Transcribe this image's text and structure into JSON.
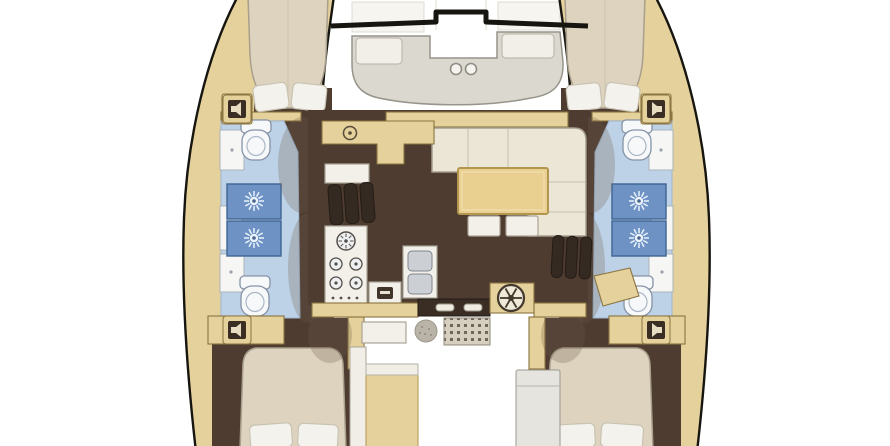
{
  "diagram": {
    "kind": "floorplan",
    "subject": "catamaran-yacht-interior-layout",
    "orientation": "bow-at-top",
    "visible_text": [],
    "features": [
      {
        "name": "forward-cockpit-bench",
        "count": 1
      },
      {
        "name": "cup-holder",
        "count": 2
      },
      {
        "name": "trampoline-crossbeam",
        "count": 1
      },
      {
        "name": "forward-cabin-berth",
        "count": 2
      },
      {
        "name": "aft-cabin-berth",
        "count": 2
      },
      {
        "name": "berth-pillow",
        "count": 8
      },
      {
        "name": "head-toilet",
        "count": 4
      },
      {
        "name": "shower-stall-with-drain",
        "count": 4
      },
      {
        "name": "vanity-cabinet",
        "count": 6
      },
      {
        "name": "deck-speaker",
        "count": 4
      },
      {
        "name": "companionway-steps",
        "count": 2
      },
      {
        "name": "galley-oven",
        "count": 1
      },
      {
        "name": "galley-burner",
        "count": 4
      },
      {
        "name": "galley-double-sink",
        "count": 1
      },
      {
        "name": "galley-counter",
        "count": 1
      },
      {
        "name": "salon-l-sofa",
        "count": 1
      },
      {
        "name": "salon-table",
        "count": 1
      },
      {
        "name": "ottoman-stool",
        "count": 2
      },
      {
        "name": "nav-desk",
        "count": 1
      },
      {
        "name": "helm-winch-wheel",
        "count": 1
      },
      {
        "name": "sliding-door-handle",
        "count": 2
      },
      {
        "name": "cockpit-grate",
        "count": 1
      },
      {
        "name": "cockpit-bench",
        "count": 2
      },
      {
        "name": "cockpit-table",
        "count": 1
      }
    ]
  },
  "colors": {
    "background": "#ffffff",
    "hull_deck": "#e5d19c",
    "deck_stroke": "#8a7440",
    "outline_dark": "#17150f",
    "floor_brown": "#4e3c31",
    "shadow_brown": "#6d5b48",
    "bath_floor": "#bdd1e7",
    "bath_stroke": "#9eb6d2",
    "shower_blue": "#6d92c3",
    "shower_stroke": "#3f6494",
    "sunburst_white": "#eaf2fc",
    "fixture_white": "#f6f7f5",
    "fixture_stroke": "#aab3bc",
    "bed_beige": "#ded3bf",
    "bed_stroke": "#a89f8c",
    "pillow_white": "#f4f2ec",
    "pillow_stroke": "#c8c3b3",
    "furniture_cream": "#ece6d7",
    "furniture_stroke": "#a39d8e",
    "table_tan": "#e9cf90",
    "table_stroke": "#b2954f",
    "bench_gray": "#dbd8cf",
    "bench_stroke": "#97948b",
    "steps_dark": "#352a22",
    "steel_gray": "#ccd0d5",
    "grate_dot": "#6e6658",
    "cockpit_gray": "#e6e4de"
  }
}
